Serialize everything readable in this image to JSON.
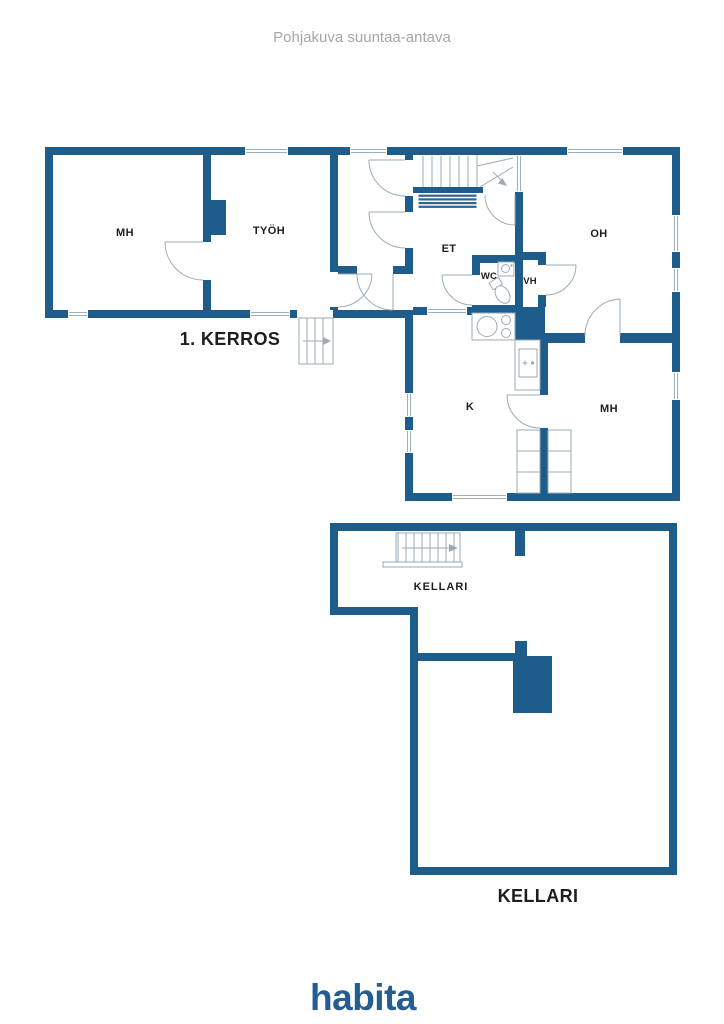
{
  "page": {
    "disclaimer": "Pohjakuva suuntaa-antava",
    "brand_logo": "habita"
  },
  "colors": {
    "wall_blue": "#1e5c8b",
    "brand_blue": "#245d92",
    "label_dark": "#1e1e1c",
    "disclaimer_gray": "#a6a6a6",
    "symbol_gray": "#9aabb8",
    "stair_stripe_blue": "#2f6390"
  },
  "floor_1": {
    "title": "1. KERROS",
    "rooms": {
      "mh_left": "MH",
      "tyoh": "TYÖH",
      "et": "ET",
      "wc": "WC",
      "vh": "VH",
      "oh": "OH",
      "k": "K",
      "mh_right": "MH"
    }
  },
  "basement": {
    "title": "KELLARI",
    "stair_room_label": "KELLARI"
  }
}
